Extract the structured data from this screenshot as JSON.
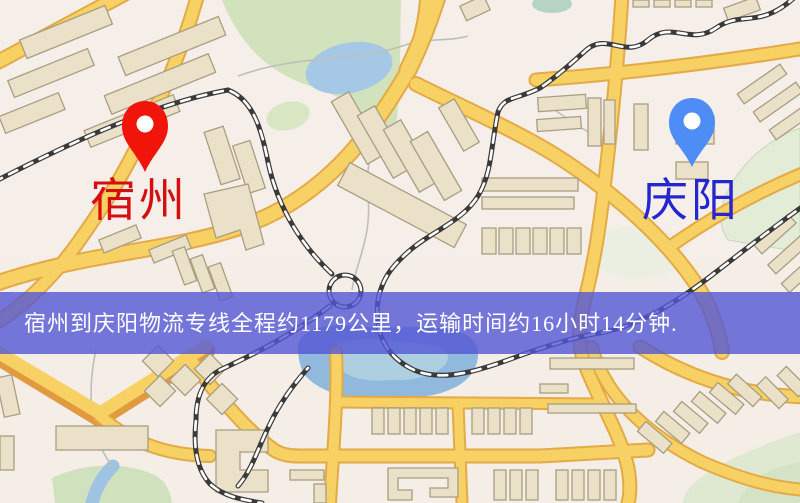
{
  "map": {
    "origin": {
      "name": "宿州"
    },
    "destination": {
      "name": "庆阳"
    },
    "banner": {
      "text": "宿州到庆阳物流专线全程约1179公里，运输时间约16小时14分钟."
    }
  },
  "colors": {
    "origin_pin": "#f0140a",
    "origin_label": "#d40f0f",
    "destination_pin": "#4d8df5",
    "destination_label": "#2426cf",
    "banner_bg": "#5256d6",
    "banner_text": "#ffffff",
    "road": "#f8d164",
    "road_border": "#e3aa47",
    "railway": "#3a3a3a",
    "park_green": "#d2e2bc",
    "water_blue": "#a5c8e6",
    "building_fill": "#eae1c8"
  }
}
